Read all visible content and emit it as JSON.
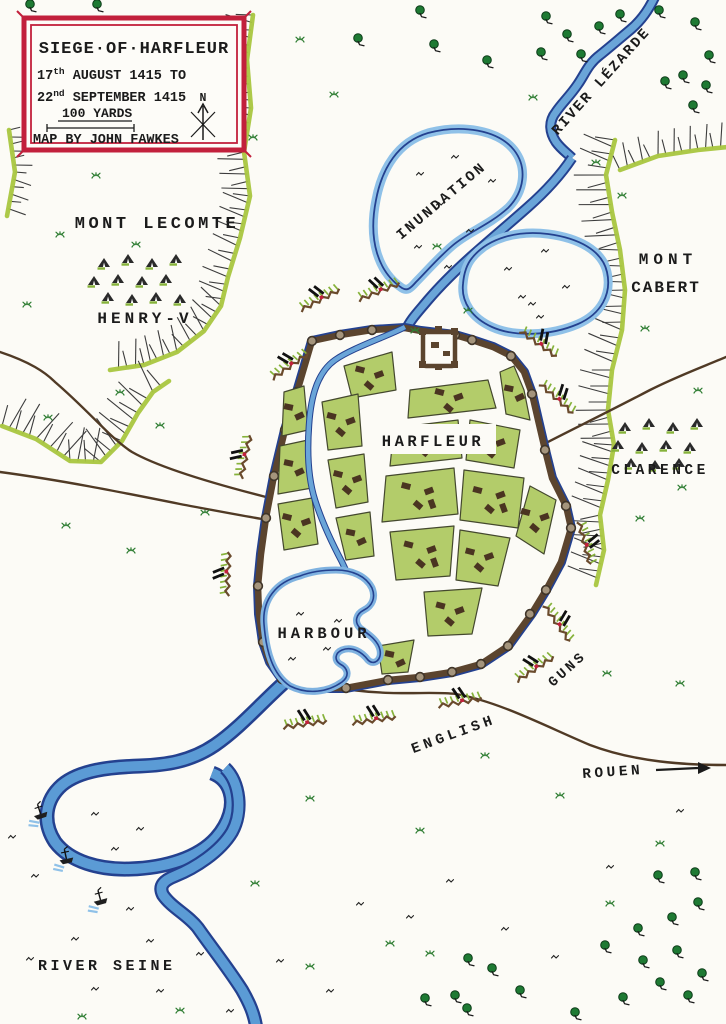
{
  "title_box": {
    "title": "SIEGE·OF·HARFLEUR",
    "date_line1_num": "17",
    "date_line1_sup": "th",
    "date_line1_rest": " AUGUST 1415  TO",
    "date_line2_num": "22",
    "date_line2_sup": "nd",
    "date_line2_rest": " SEPTEMBER 1415",
    "scale_label": "100 YARDS",
    "credit": "MAP BY JOHN FAWKES",
    "compass_north": "N"
  },
  "places": {
    "mont_lecomte": "MONT LECOMTE",
    "henry_v_camp": "HENRY-V",
    "river_lezarde": "RIVER LÉZARDE",
    "inundation": "INUNDATION",
    "mont_cabert_line1": "MONT",
    "mont_cabert_line2": "CABERT",
    "clarence_camp": "CLARENCE",
    "town": "HARFLEUR",
    "harbour": "HARBOUR",
    "guns": "GUNS",
    "english_lines": "ENGLISH",
    "road_to_rouen": "ROUEN",
    "river_seine": "RIVER SEINE"
  },
  "colors": {
    "paper": "#fcfbf6",
    "ink": "#1b1b1b",
    "frame_red": "#c2203c",
    "water_fill": "#5b9bd5",
    "water_light": "#8fc1e8",
    "water_edge": "#24418f",
    "town_green": "#b3cc6a",
    "ridge_green": "#a9c63f",
    "hatch_gray": "#3c3c3c",
    "wall_brown": "#5b442e",
    "tower_fill": "#a4947c",
    "road_brown": "#503a25",
    "tree_green": "#1e7a33",
    "grass_green": "#2e7d32",
    "building_brown": "#4a3421",
    "battery_green": "#86b23a",
    "trench_brown": "#6a4a2c"
  }
}
